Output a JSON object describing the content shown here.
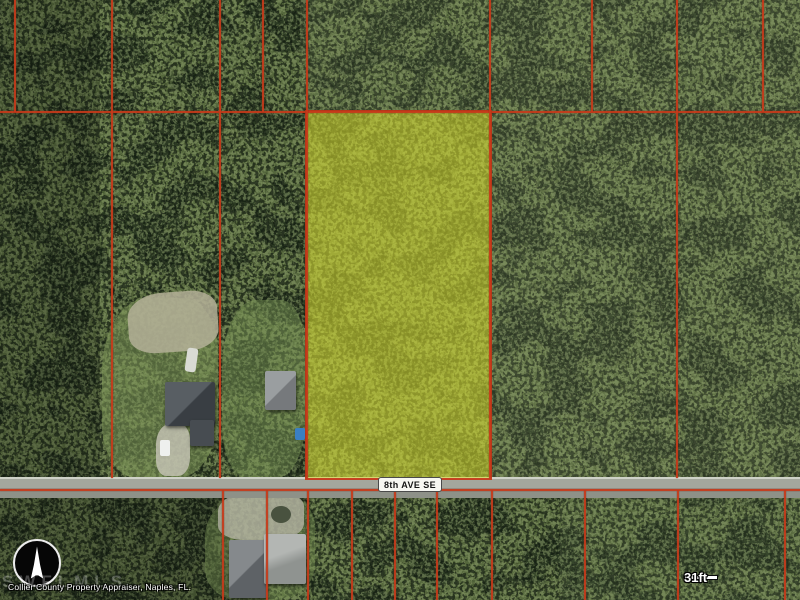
{
  "map": {
    "description": "Aerial parcel map with highlighted lot",
    "road": {
      "label": "8th AVE SE"
    },
    "attribution": {
      "text": "Collier County Property Appraiser, Naples, FL.",
      "watermark": "SWFLMLS"
    },
    "scale_bar": {
      "start": "0",
      "end": "31ft"
    },
    "compass": {
      "direction": "N"
    },
    "colors": {
      "parcel_line": "#c63a1a",
      "highlight_parcel": "#d6db34",
      "road": "#a4a79d",
      "forest": "#2c3a23"
    }
  }
}
